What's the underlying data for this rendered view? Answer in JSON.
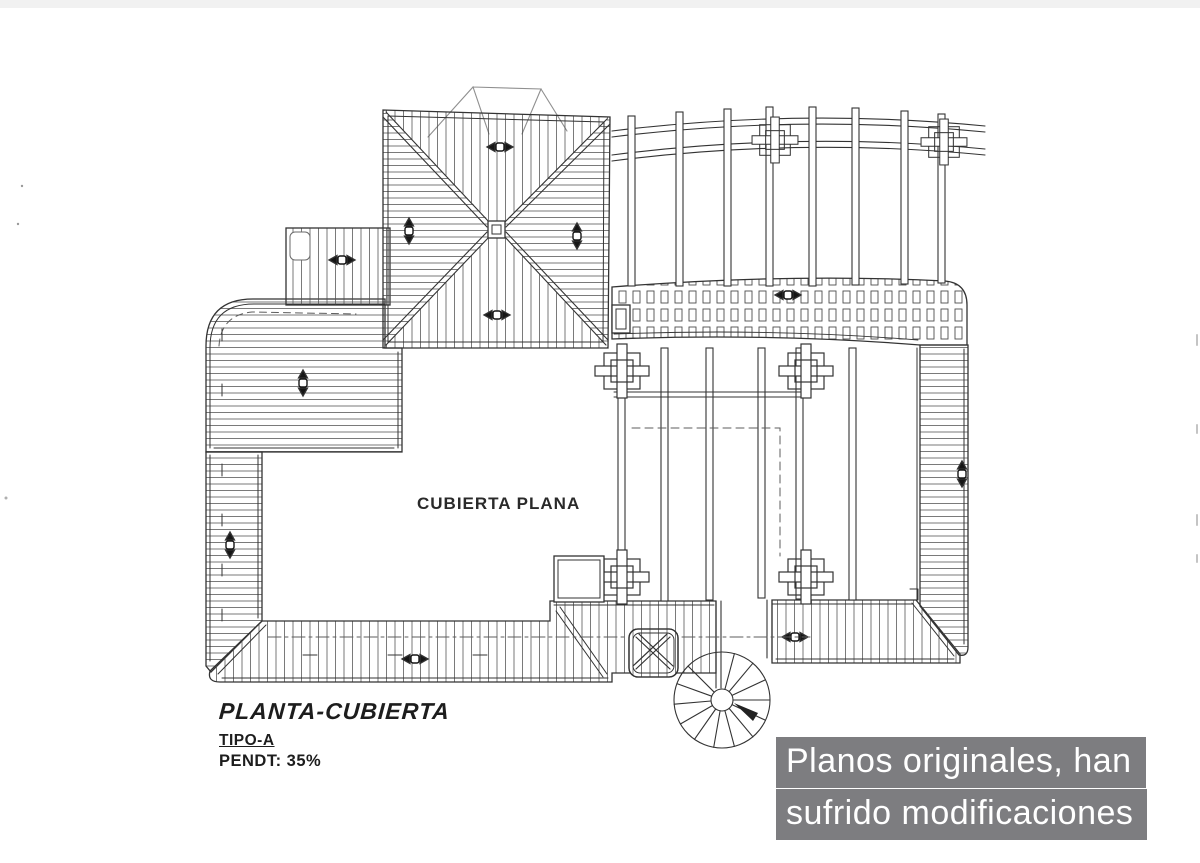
{
  "theme": {
    "paper": "#ffffff",
    "top_bar": "#f1f1f1",
    "ink": "#333333",
    "hatch": "#4d4d4d",
    "overlay_bg": "#7d7d80",
    "overlay_text": "#ffffff"
  },
  "drawing": {
    "flat_roof_label": "CUBIERTA PLANA",
    "title": "PLANTA-CUBIERTA",
    "type_line": "TIPO-A",
    "slope_line": "PENDT: 35%"
  },
  "overlay": {
    "line1": "Planos originales, han",
    "line2": "sufrido modificaciones"
  }
}
